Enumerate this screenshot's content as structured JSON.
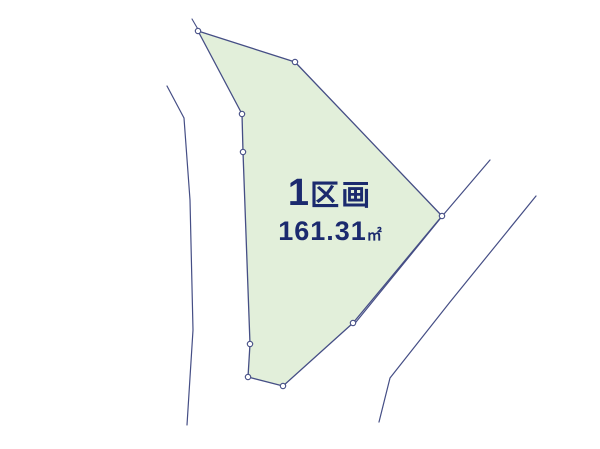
{
  "plot": {
    "label_number": "1",
    "label_suffix": "区画",
    "area_value": "161.31",
    "area_unit": "㎡"
  },
  "colors": {
    "background": "#ffffff",
    "plot_fill": "#e2efda",
    "line": "#454e85",
    "text": "#1b2a6e"
  },
  "geometry": {
    "plot_polygon": [
      [
        198,
        31
      ],
      [
        295,
        62
      ],
      [
        442,
        216
      ],
      [
        353,
        323
      ],
      [
        283,
        386
      ],
      [
        248,
        377
      ],
      [
        250,
        344
      ],
      [
        243,
        152
      ],
      [
        242,
        114
      ]
    ],
    "vertex_markers": [
      [
        198,
        31
      ],
      [
        295,
        62
      ],
      [
        442,
        216
      ],
      [
        353,
        323
      ],
      [
        283,
        386
      ],
      [
        248,
        377
      ],
      [
        250,
        344
      ],
      [
        243,
        152
      ],
      [
        242,
        114
      ]
    ],
    "boundary_extension": [
      [
        199,
        31
      ],
      [
        192,
        19
      ]
    ],
    "road_lines": [
      [
        [
          167,
          86
        ],
        [
          184,
          118
        ],
        [
          190,
          200
        ],
        [
          193,
          330
        ],
        [
          187,
          425
        ]
      ],
      [
        [
          490,
          160
        ],
        [
          444,
          214
        ],
        [
          356,
          322
        ]
      ],
      [
        [
          536,
          196
        ],
        [
          450,
          302
        ],
        [
          390,
          378
        ],
        [
          379,
          422
        ]
      ]
    ],
    "marker_radius": 2.7
  }
}
